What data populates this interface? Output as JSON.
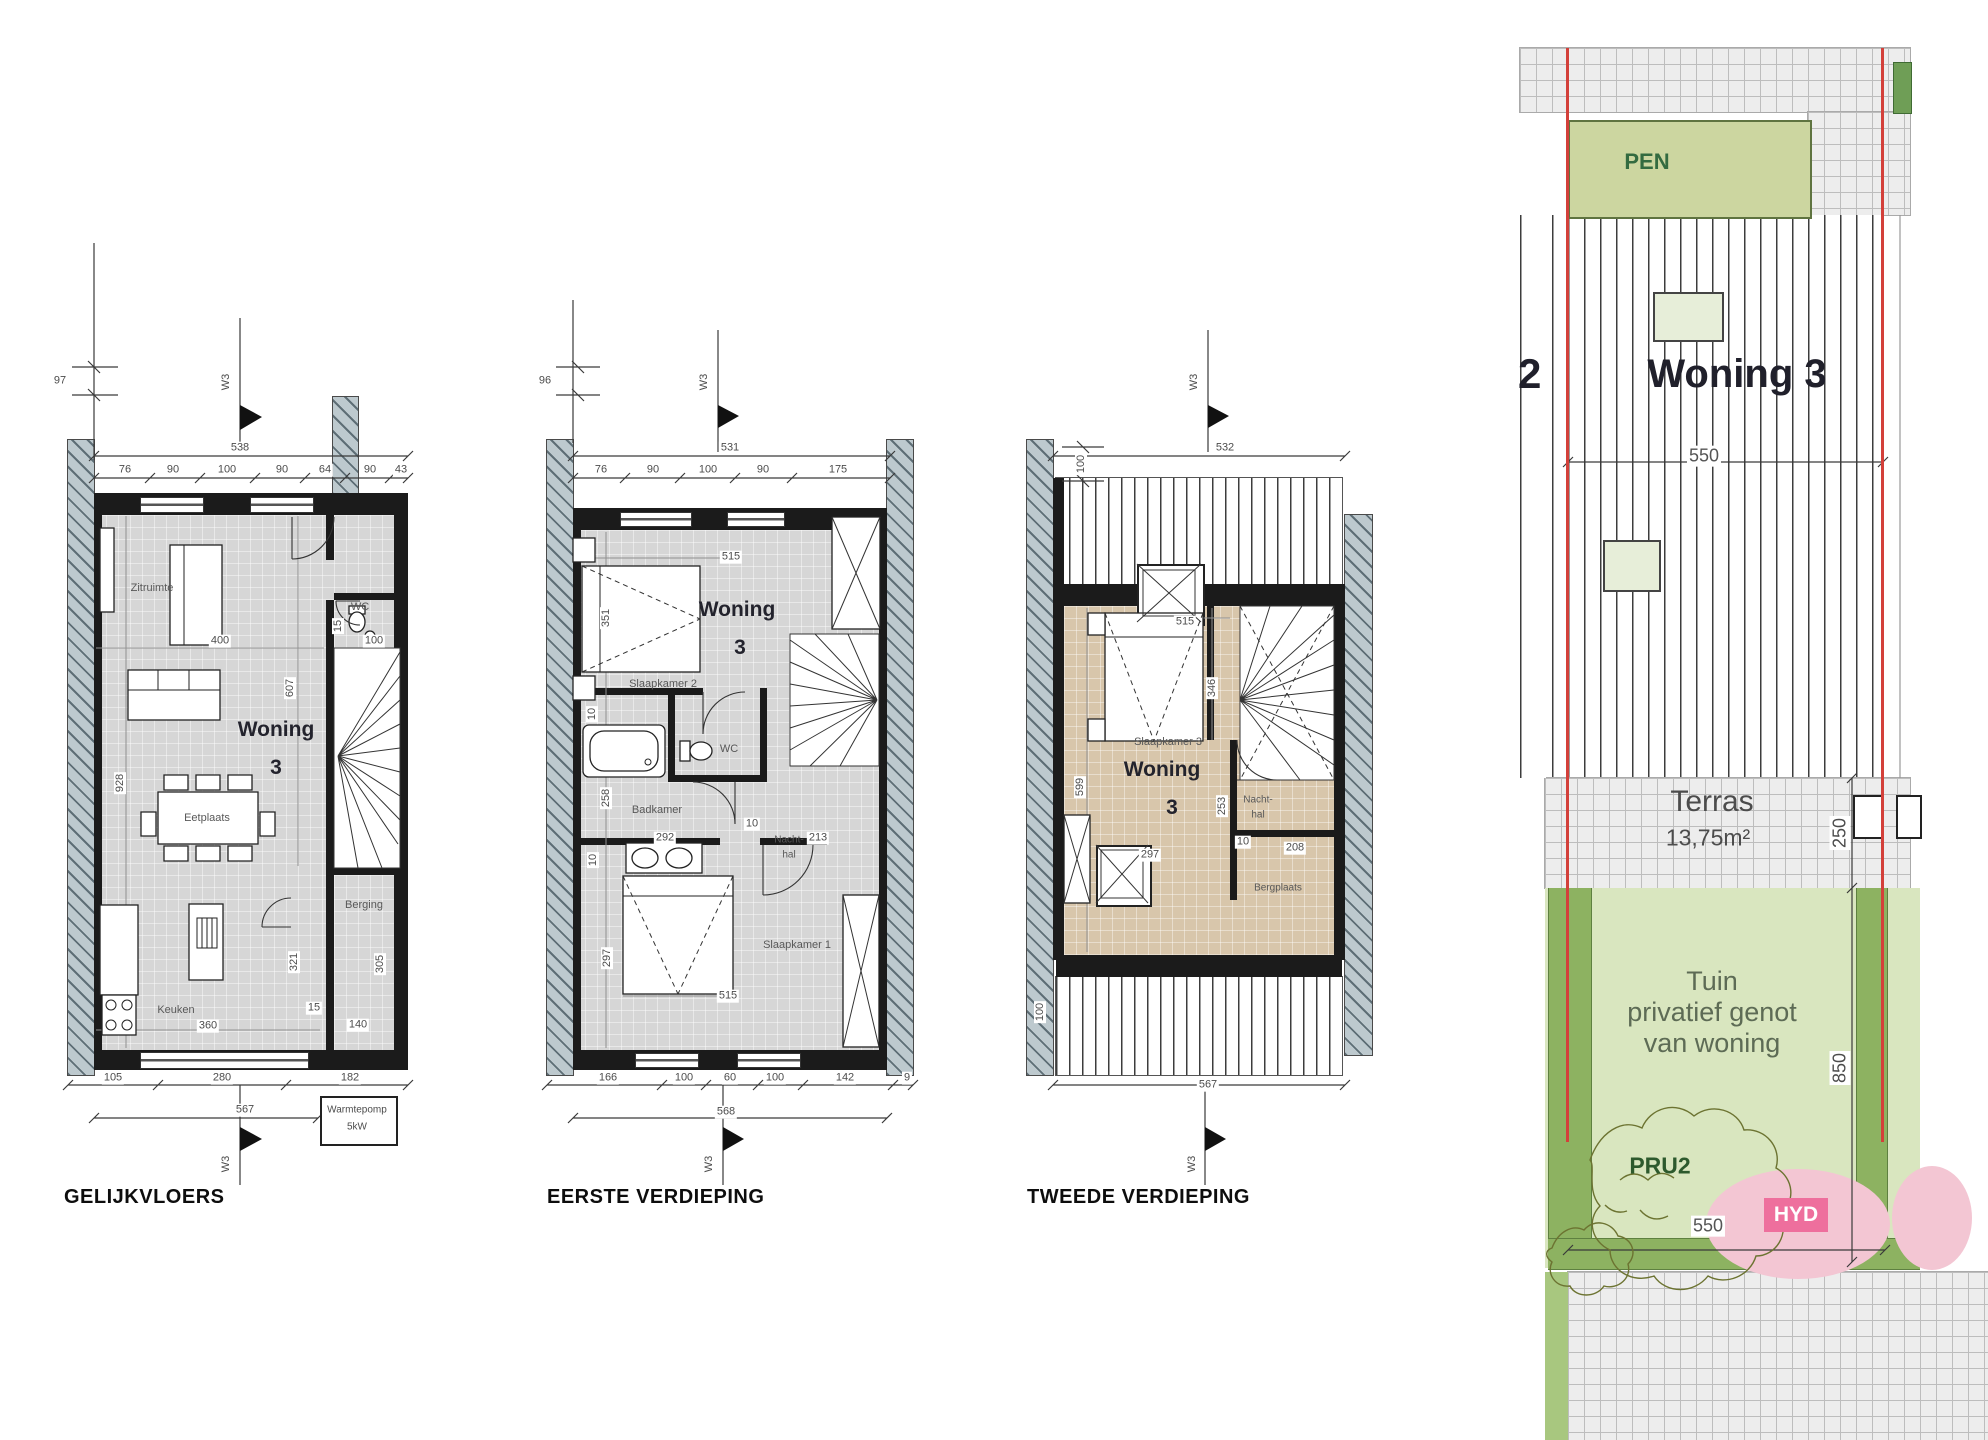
{
  "colors": {
    "wall": "#1b1b1b",
    "floor_gray": "#d6d6d6",
    "floor_tan": "#d8c6ab",
    "party_wall_hatch": "#bdc9ce",
    "pen_green": "#ccd6a0",
    "garden_green": "#d9e6bf",
    "hedge_green": "#8db261",
    "pink_zone": "#f3c6d3",
    "hyd_badge": "#ee6f9d",
    "boundary_red": "#d3403a",
    "skylight_green": "#e7eed9"
  },
  "plans": {
    "p1": {
      "title": "GELIJKVLOERS",
      "marker": "W3",
      "offset": "97",
      "total_top": "538",
      "top_dims": [
        "76",
        "90",
        "100",
        "90",
        "64",
        "90",
        "43"
      ],
      "room_zitruimte": "Zitruimte",
      "room_wc": "WC",
      "room_eetplaats": "Eetplaats",
      "room_berging": "Berging",
      "room_keuken": "Keuken",
      "woning_line1": "Woning",
      "woning_line2": "3",
      "d400": "400",
      "d15_wc": "15",
      "d100_wc": "100",
      "d607": "607",
      "d928": "928",
      "d321": "321",
      "d15_door": "15",
      "d140": "140",
      "d305": "305",
      "d360": "360",
      "bottom_dims": [
        "105",
        "280",
        "182"
      ],
      "total_bottom": "567",
      "warmtepomp_line1": "Warmtepomp",
      "warmtepomp_line2": "5kW"
    },
    "p2": {
      "title": "EERSTE VERDIEPING",
      "marker": "W3",
      "offset": "96",
      "total_top": "531",
      "top_dims": [
        "76",
        "90",
        "100",
        "90",
        "175"
      ],
      "room_slk2": "Slaapkamer 2",
      "room_wc": "WC",
      "room_badkamer": "Badkamer",
      "room_nachthal_line1": "Nacht-",
      "room_nachthal_line2": "hal",
      "room_slk1": "Slaapkamer 1",
      "woning_line1": "Woning",
      "woning_line2": "3",
      "d515_top": "515",
      "d351": "351",
      "d10_a": "10",
      "d258": "258",
      "d292": "292",
      "d10_b": "10",
      "d213": "213",
      "d10_c": "10",
      "d297": "297",
      "d515_bottom": "515",
      "bottom_dims": [
        "166",
        "100",
        "60",
        "100",
        "142"
      ],
      "bottom_partial": "9",
      "total_bottom": "568"
    },
    "p3": {
      "title": "TWEEDE VERDIEPING",
      "marker": "W3",
      "offset_top": "100",
      "offset_bottom": "100",
      "total_top": "532",
      "room_slk3": "Slaapkamer 3",
      "room_nachthal_line1": "Nacht-",
      "room_nachthal_line2": "hal",
      "room_bergplaats": "Bergplaats",
      "woning_line1": "Woning",
      "woning_line2": "3",
      "d515": "515",
      "d346": "346",
      "d599": "599",
      "d297": "297",
      "d253": "253",
      "d10": "10",
      "d208": "208",
      "total_bottom": "567"
    }
  },
  "site": {
    "pen": "PEN",
    "woning_big": "Woning 3",
    "neighbor_partial": "2",
    "d550_roof": "550",
    "terras": "Terras",
    "terras_area": "13,75m²",
    "d250": "250",
    "tuin_line1": "Tuin",
    "tuin_line2": "privatief genot",
    "tuin_line3": "van woning",
    "d850": "850",
    "pru2": "PRU2",
    "hyd": "HYD",
    "d550_garden": "550"
  }
}
